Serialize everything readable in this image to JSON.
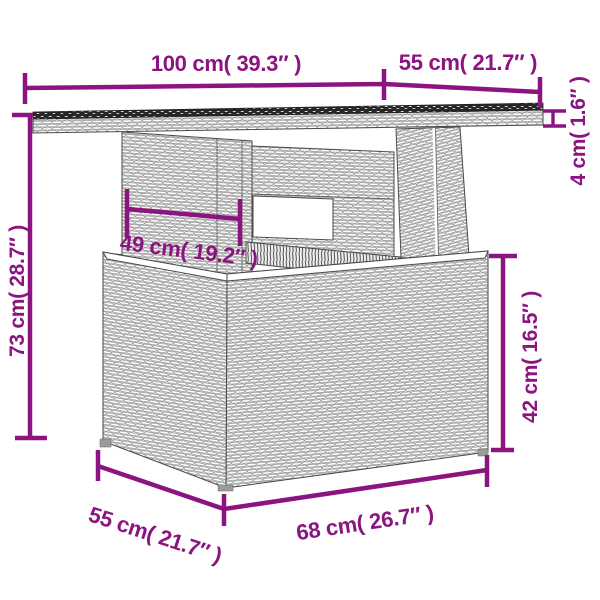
{
  "accent_color": "#8C1480",
  "line_color": "#4a4a4a",
  "background": "#ffffff",
  "dims": {
    "top_width": {
      "label": "100 cm( 39.3″ )",
      "value_cm": 100,
      "value_inch": 39.3
    },
    "top_overhang": {
      "label": "55 cm( 21.7″ )",
      "value_cm": 55,
      "value_inch": 21.7
    },
    "top_thickness": {
      "label": "4 cm( 1.6″ )",
      "value_cm": 4,
      "value_inch": 1.6
    },
    "clearance": {
      "label": "49 cm( 19.2″ )",
      "value_cm": 49,
      "value_inch": 19.2
    },
    "total_height": {
      "label": "73 cm( 28.7″ )",
      "value_cm": 73,
      "value_inch": 28.7
    },
    "base_height": {
      "label": "42 cm( 16.5″ )",
      "value_cm": 42,
      "value_inch": 16.5
    },
    "base_depth": {
      "label": "55 cm( 21.7″ )",
      "value_cm": 55,
      "value_inch": 21.7
    },
    "base_width": {
      "label": "68 cm( 26.7″ )",
      "value_cm": 68,
      "value_inch": 26.7
    }
  }
}
